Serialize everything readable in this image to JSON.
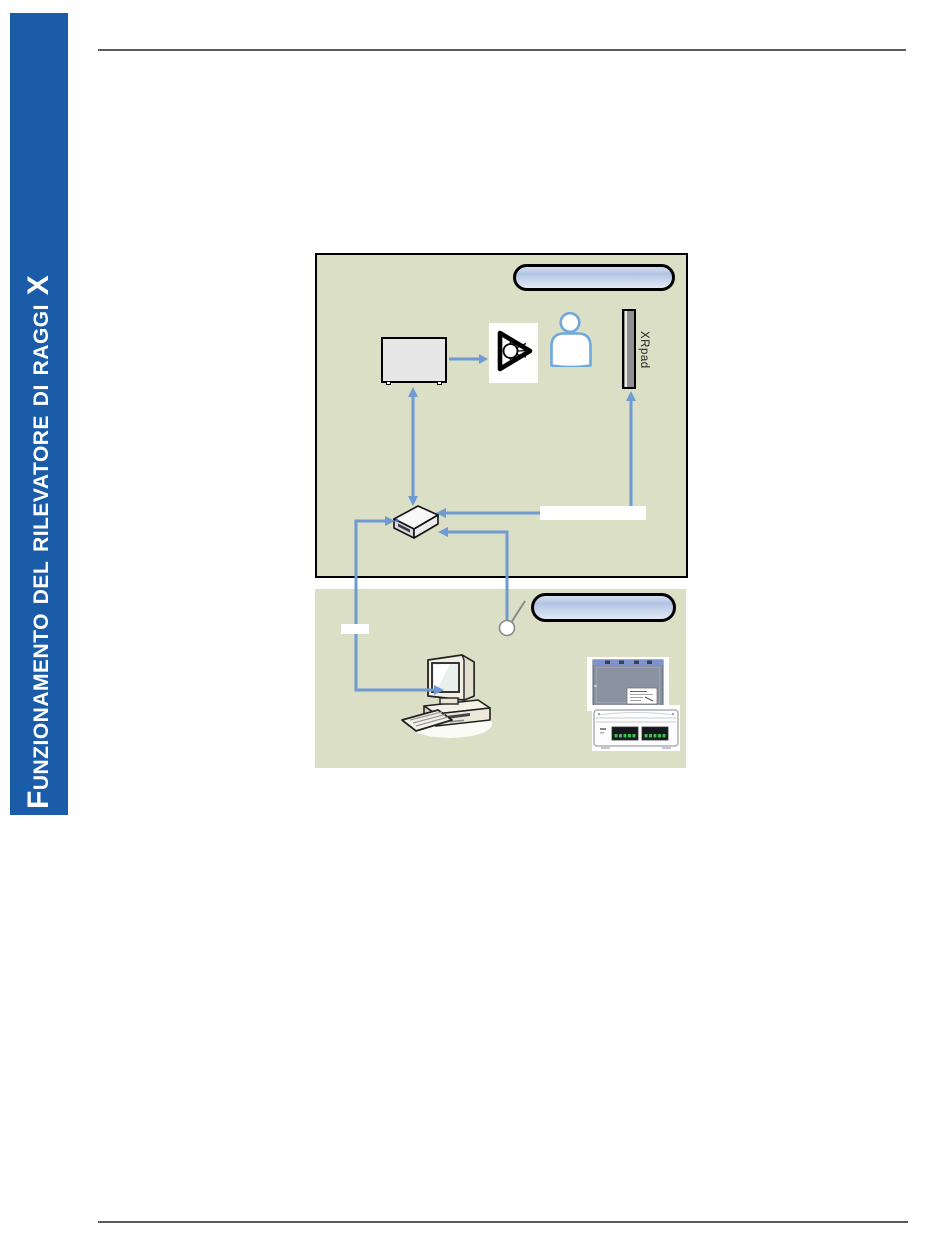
{
  "sidebar": {
    "label": "Funzionamento del rilevatore di raggi X",
    "background_color": "#1a5ca8",
    "text_color": "#ffffff"
  },
  "diagram": {
    "room_background_color": "#dbdfc5",
    "room_border_color": "#000000",
    "arrow_color": "#6f9ad2",
    "pill_gradient": [
      "#d6dff0",
      "#b2c4e4",
      "#e2e9f5"
    ],
    "upper_room_banner": "",
    "lower_room_banner": "",
    "detector_label": "XRpad"
  },
  "rules": {
    "color": "#595959"
  }
}
